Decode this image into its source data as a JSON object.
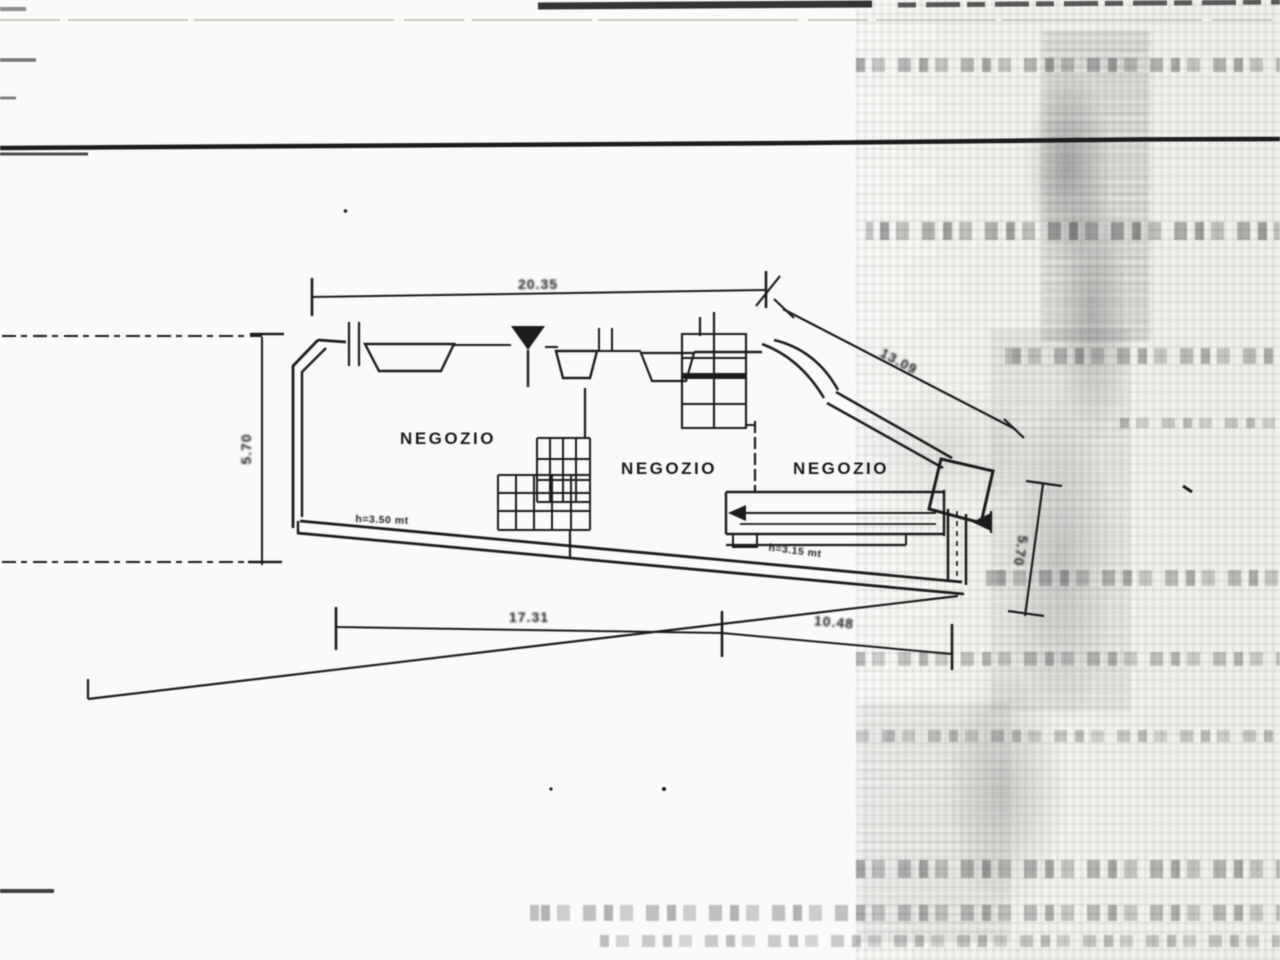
{
  "scan": {
    "paper_color": "#fbfaf8",
    "ink_color": "#1e1e1e",
    "noise_color": "#6b6b6b"
  },
  "plan": {
    "rooms": [
      {
        "label": "NEGOZIO"
      },
      {
        "label": "NEGOZIO"
      },
      {
        "label": "NEGOZIO"
      }
    ],
    "height_notes": [
      {
        "text": "h=3.50 mt"
      },
      {
        "text": "h=3.15 mt"
      }
    ],
    "dimensions": {
      "top_width": "20.35",
      "left_depth": "5.70",
      "diagonal_width": "13.09",
      "right_depth": "5.70",
      "bottom_left_width": "17.31",
      "bottom_right_width": "10.48"
    }
  }
}
